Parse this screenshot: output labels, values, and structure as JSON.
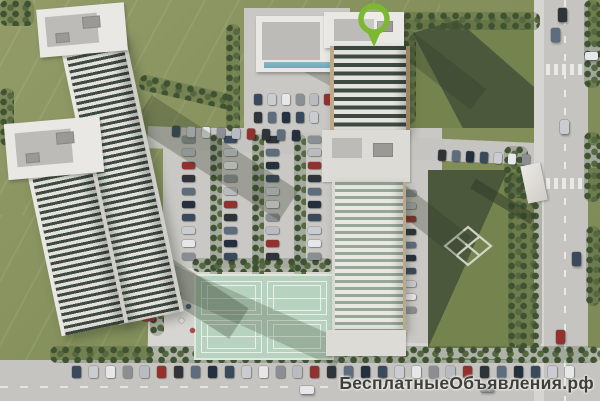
{
  "watermark": {
    "text": "БесплатныеОбъявления.рф"
  },
  "marker": {
    "label": "location-pin"
  },
  "colors": {
    "grass_base": "#84905c",
    "grass_light": "#939c68",
    "park_green": "#75834f",
    "shadow_green": "#47523a",
    "tree_dark": "#3f5232",
    "tree_mid": "#55683f",
    "pavement": "#c9c8c4",
    "pavement_light": "#d6d5d1",
    "road": "#c5c4c0",
    "building_white": "#e9e8e4",
    "roof_gray": "#bcbbb7",
    "glass_dark": "#3e4a43",
    "glass_mid": "#96a697",
    "facade_tan": "#b49b7f",
    "pool_blue": "#6fa9bc",
    "court_mint": "#b7d3bf",
    "court_line": "#e8f0e8",
    "path_line": "#dce0d4",
    "pin_green": "#7cb832",
    "watermark_ink": "#3e3e3c"
  },
  "car_colors": [
    "#3a4a5c",
    "#93312e",
    "#c9cdd1",
    "#2e3438",
    "#e6e7e8",
    "#5d6d7d",
    "#8a8f94",
    "#24303e",
    "#b8bcc0"
  ]
}
